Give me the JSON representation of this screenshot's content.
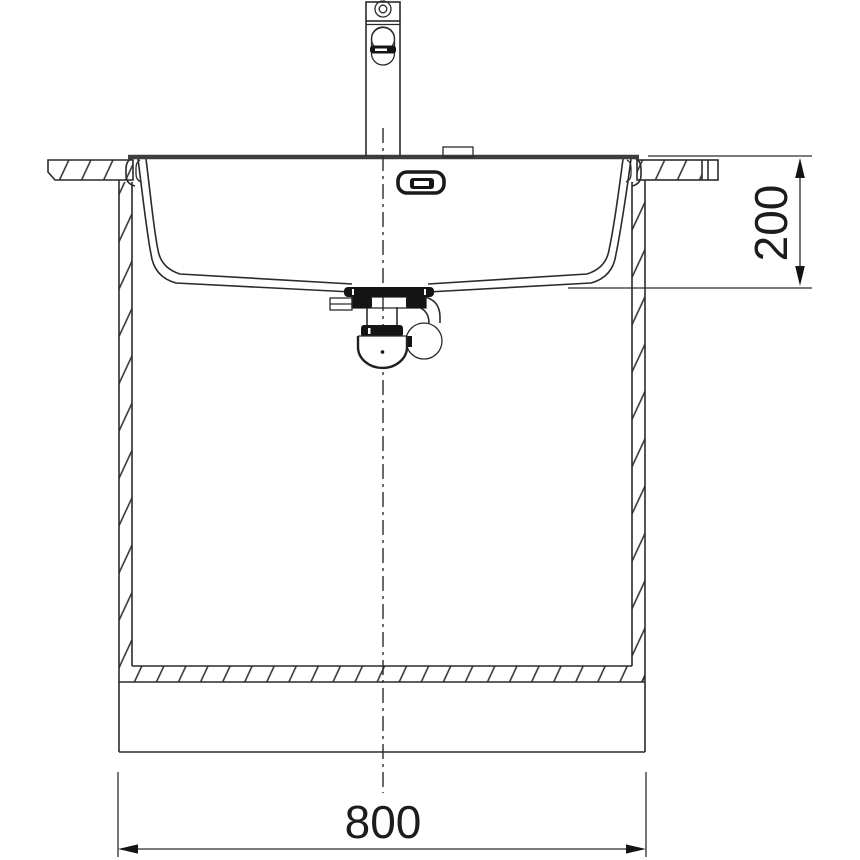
{
  "drawing": {
    "kind": "sink-installation-cross-section",
    "background_color": "#ffffff",
    "line_color": "#2b2b2b",
    "dark_fill_color": "#141414",
    "dimensions": {
      "width": {
        "value": "800",
        "orientation": "horizontal",
        "position": "bottom"
      },
      "depth": {
        "value": "200",
        "orientation": "vertical",
        "position": "right"
      }
    },
    "parts": {
      "tap": "single-lever-mixer-tap",
      "rim": "sink-rim",
      "bowl": "sink-bowl",
      "overflow": "overflow-slot",
      "drain": "siphon-drain-assembly",
      "worktop": "worktop-section-hatched",
      "cabinet": "base-cabinet-section",
      "centerline": "vertical-center-axis"
    }
  }
}
